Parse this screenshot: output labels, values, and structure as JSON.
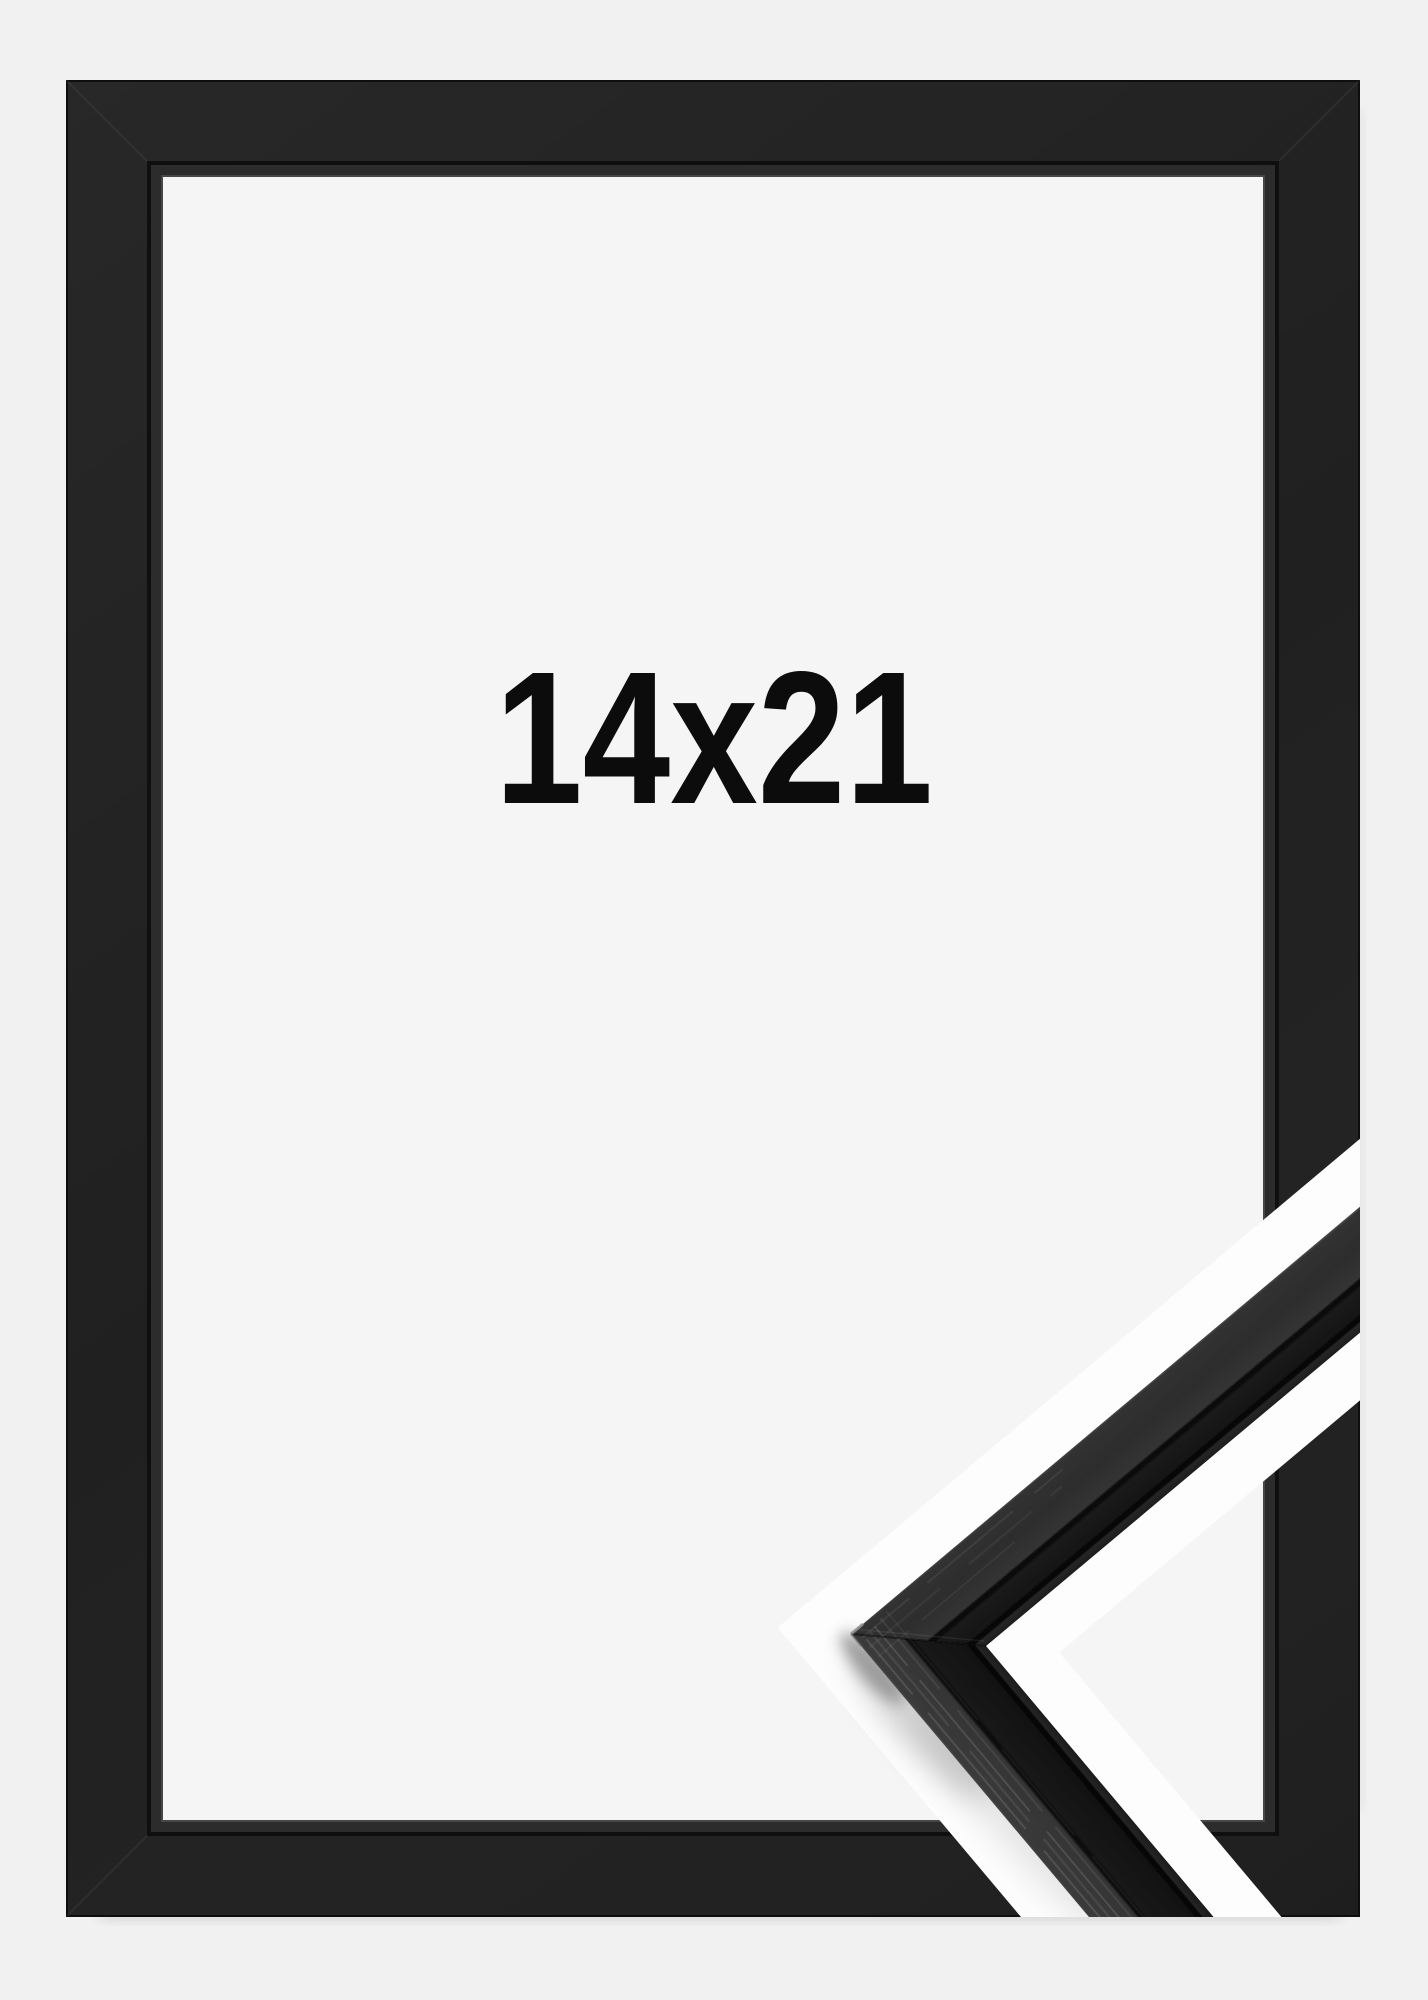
{
  "product": {
    "size_label": "14x21"
  },
  "colors": {
    "background": "#f1f1f2",
    "opening": "#f5f5f6",
    "frame_face": "#202020",
    "frame_inner_lip": "#2c2c2c",
    "frame_crease": "#0f0f0f",
    "outline_white": "#fdfdfd",
    "label_text": "#0c0c0c",
    "sample_side_face": "#313131",
    "sample_front_face": "#161616"
  }
}
